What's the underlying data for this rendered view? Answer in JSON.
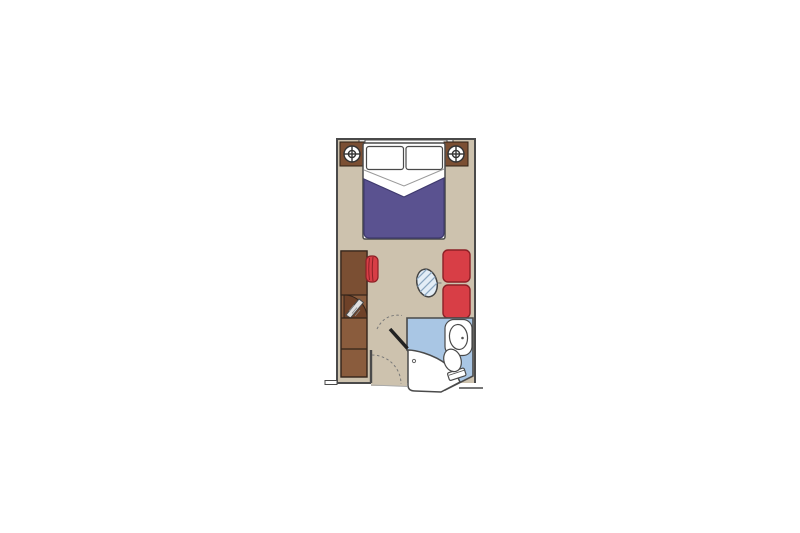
{
  "scene": {
    "kind": "cruise-cabin-floor-plan",
    "orientation": "vertical",
    "rooms": {
      "main_cabin": "cabin with double bed, desk, wardrobe and sofa",
      "bathroom": "en-suite bathroom with sink, toilet and shower"
    },
    "elements": {
      "window": "picture-window",
      "nightstand_left": "nightstand-with-lamp",
      "nightstand_right": "nightstand-with-lamp",
      "lamp": "lamp-icon",
      "bed": "double-bed",
      "pillow_left": "pillow",
      "pillow_right": "pillow",
      "duvet": "duvet",
      "desk": "desk-unit",
      "stool": "stool",
      "wardrobe": "wardrobe",
      "closet_door": "closet-door-open",
      "sofa": "two-seat-sofa",
      "table": "glass-table",
      "sink": "sink",
      "toilet": "toilet",
      "shower": "shower-pod",
      "bathroom_door": "bathroom-door-open",
      "entry_door": "entry-door-swing"
    }
  },
  "colors": {
    "wall": "#4a4a4a",
    "floor": "#cdc2ae",
    "wood": "#8a5c3d",
    "wood_dark": "#7b4f33",
    "wood_shadow": "#6e4128",
    "wood_line": "#33241a",
    "linen": "#ffffff",
    "duvet": "#5a5290",
    "duvet_line": "#3f3a6e",
    "red": "#d83e46",
    "red_dark": "#8c2026",
    "bath": "#a9c6e4",
    "fixture": "#ffffff",
    "glass": "#e3edf6",
    "glass_hatch": "#8aa6c0",
    "metal": "#e0e0e0",
    "swing": "#777777",
    "fold": "#9a9a9a"
  }
}
